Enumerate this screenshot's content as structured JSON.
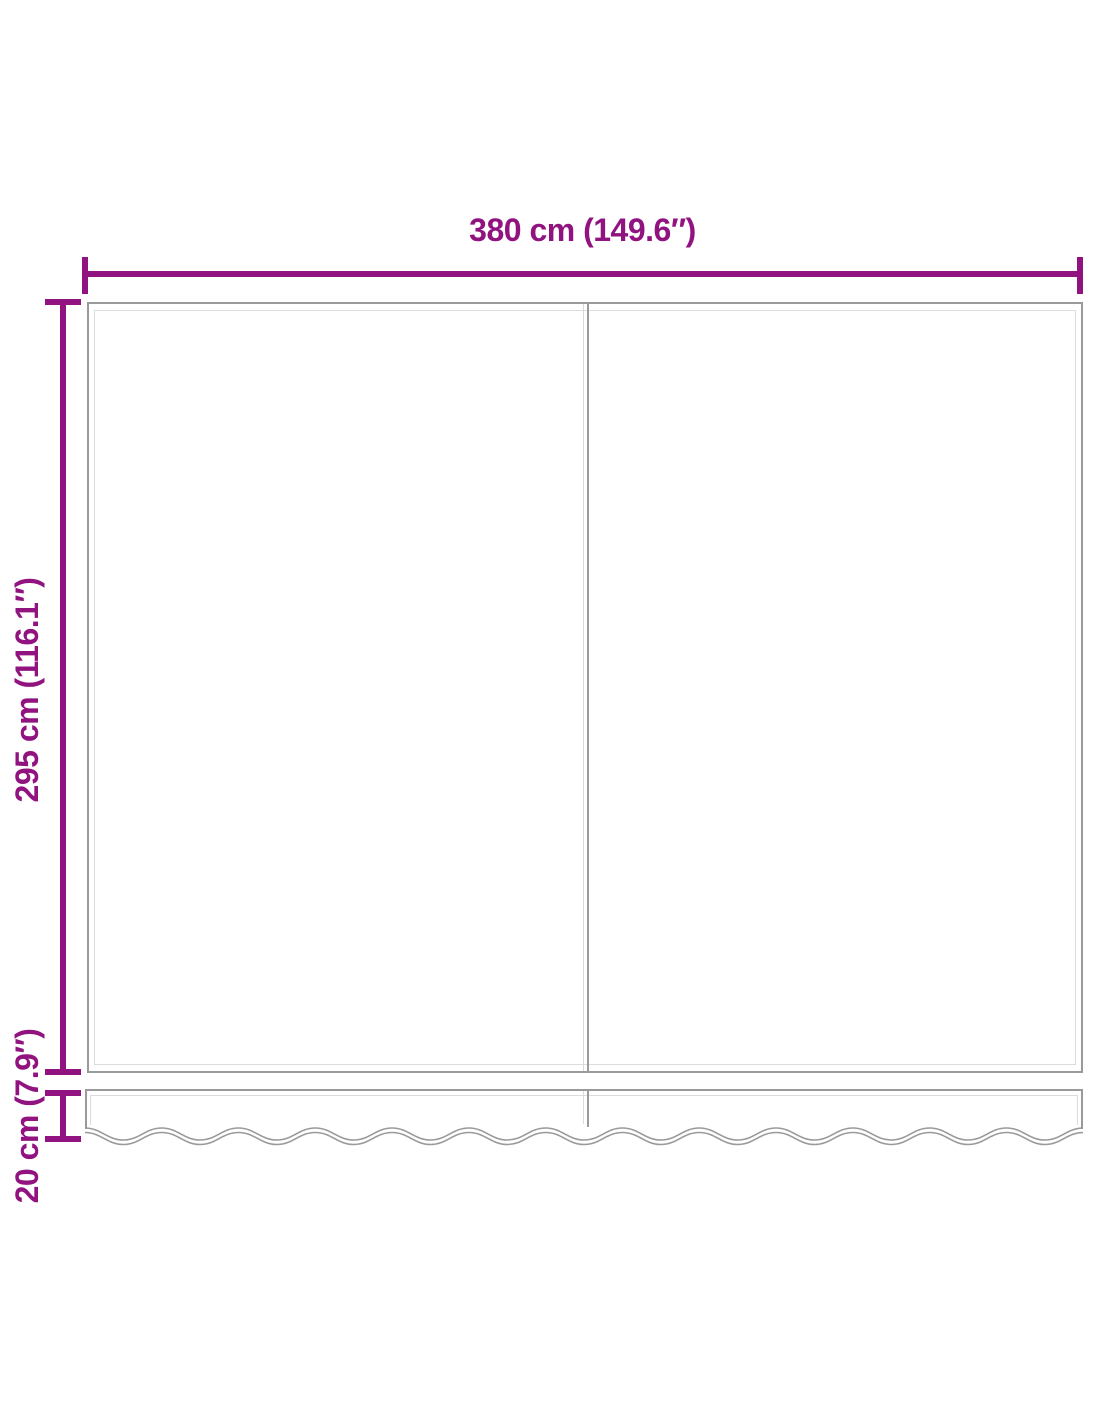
{
  "diagram": {
    "type": "product-dimension-diagram",
    "subject": "awning-replacement-fabric-with-valance",
    "dimensions": {
      "width": {
        "label": "380 cm (149.6″)"
      },
      "height": {
        "label": "295 cm (116.1″)"
      },
      "valance": {
        "label": "20 cm (7.9″)"
      }
    },
    "colors": {
      "dimension_accent": "#911380",
      "fabric_outline": "#9a9a9a",
      "fabric_inner_line": "#dcdcdc",
      "background": "#ffffff"
    }
  }
}
